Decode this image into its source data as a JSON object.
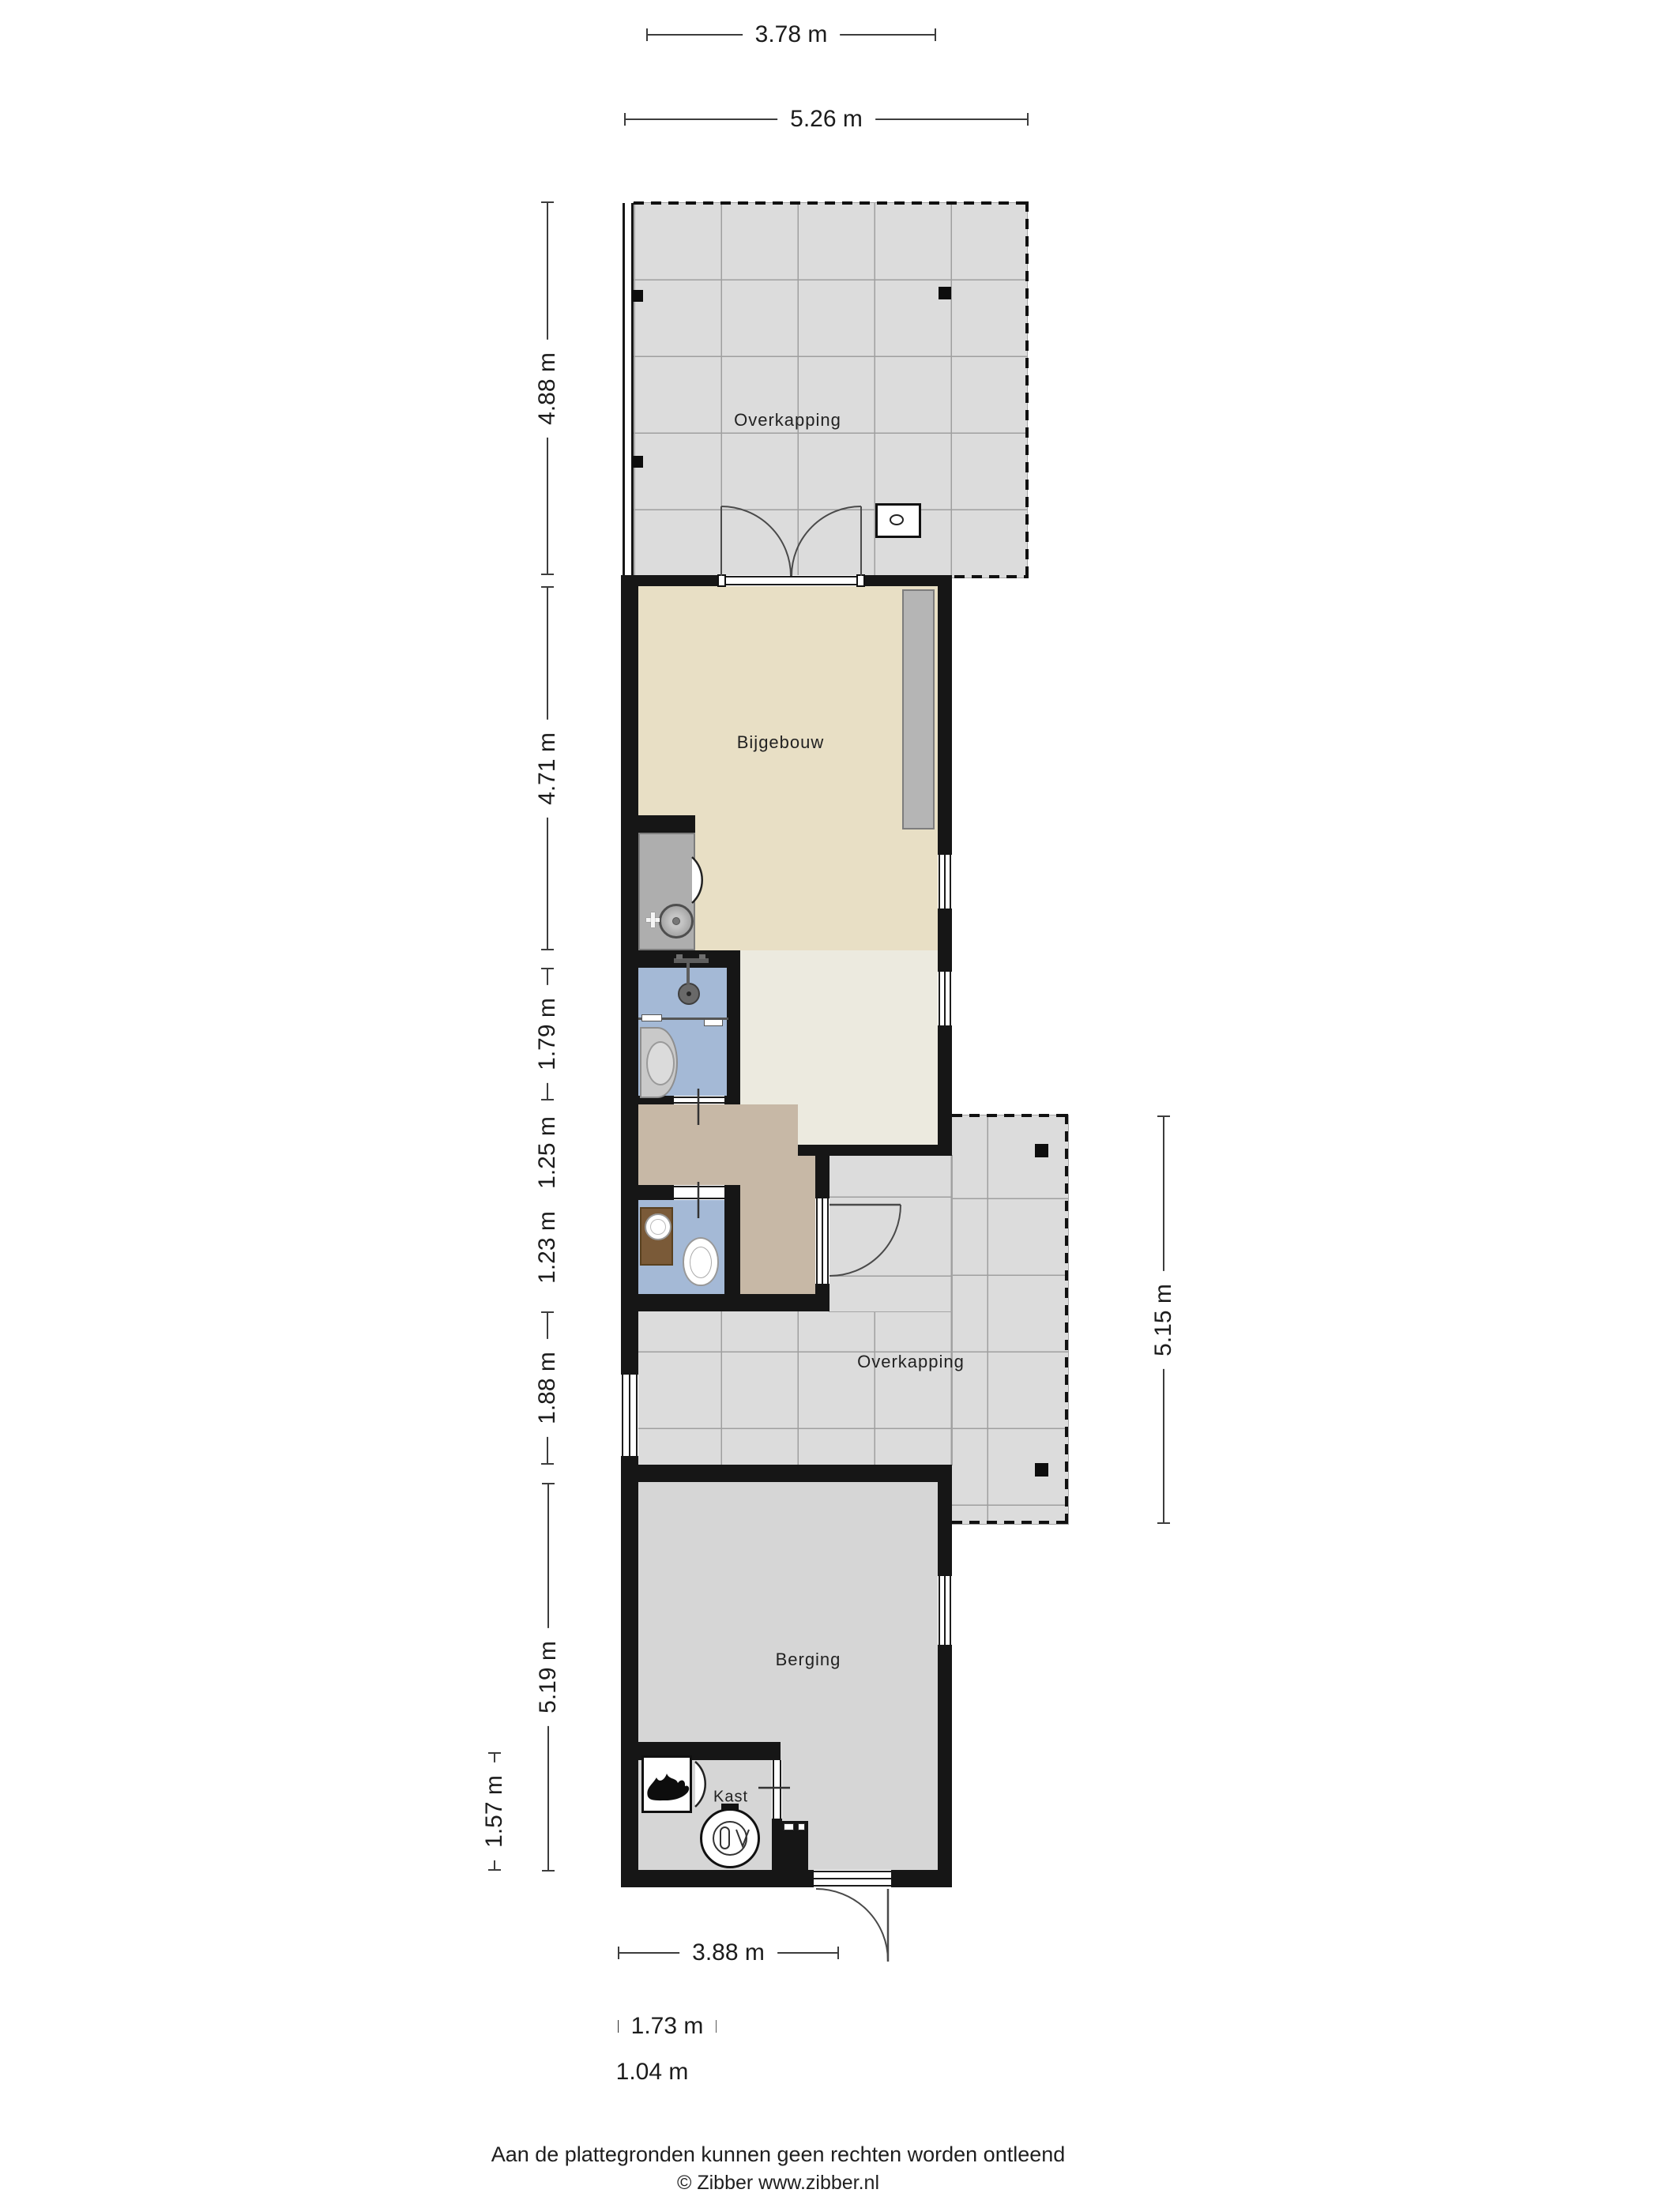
{
  "rooms": {
    "overkapping_top": {
      "label": "Overkapping"
    },
    "bijgebouw": {
      "label": "Bijgebouw"
    },
    "overkapping_side": {
      "label": "Overkapping"
    },
    "berging": {
      "label": "Berging"
    },
    "kast": {
      "label": "Kast"
    }
  },
  "dimensions": {
    "top_inner_width": {
      "label": "3.78 m"
    },
    "top_outer_width": {
      "label": "5.26 m"
    },
    "overkapping_top_depth": {
      "label": "4.88 m"
    },
    "bijgebouw_length": {
      "label": "4.71 m"
    },
    "shower_section": {
      "label": "1.79 m"
    },
    "hall_section": {
      "label": "1.25 m"
    },
    "toilet_section": {
      "label": "1.23 m"
    },
    "passage_section": {
      "label": "1.88 m"
    },
    "berging_length": {
      "label": "5.19 m"
    },
    "kast_height": {
      "label": "1.57 m"
    },
    "overkapping_side_depth": {
      "label": "5.15 m"
    },
    "berging_width": {
      "label": "3.88 m"
    },
    "kast_width": {
      "label": "1.73 m"
    },
    "door_width": {
      "label": "1.04 m"
    }
  },
  "footer": {
    "disclaimer": "Aan de plattegronden kunnen geen rechten worden ontleend",
    "copyright": "© Zibber www.zibber.nl"
  },
  "icons": {
    "flame": "flame-icon",
    "washing_machine": "washing-machine-icon",
    "shower": "shower-head-icon",
    "round_sink": "round-sink-icon",
    "washbasin": "washbasin-icon",
    "toilet": "toilet-icon",
    "stove": "stove-icon",
    "hob_circle": "hob-circle-icon"
  },
  "colors": {
    "wall": "#161616",
    "tile": "#dcdcdc",
    "beige": "#e8dfc5",
    "cream": "#eceadf",
    "taupe": "#c7b8a6",
    "blue": "#a4b9d6",
    "berging": "#d6d6d6",
    "counter": "#aeaeae",
    "counter2": "#b5b5b5",
    "brown": "#7a5a38"
  }
}
